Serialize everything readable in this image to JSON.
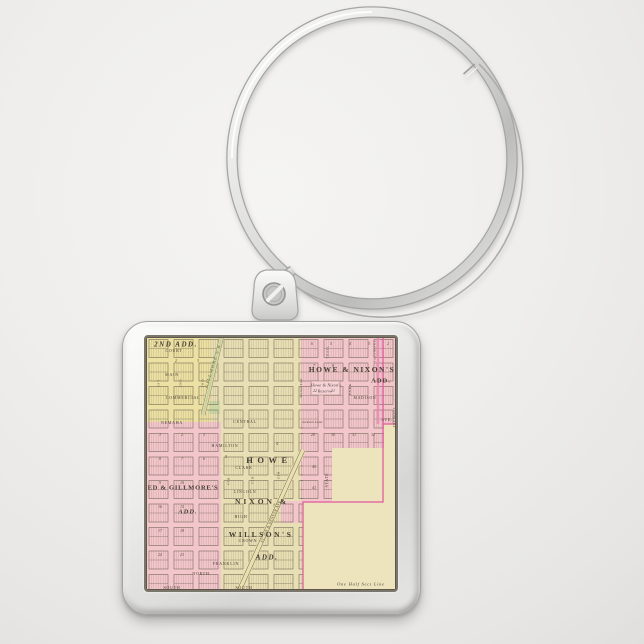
{
  "scene": {
    "background": "#efeeec",
    "metal_light": "#fbfbf9",
    "metal_mid": "#d8d8d6",
    "metal_dark": "#a8a8a6"
  },
  "map": {
    "colors": {
      "cream": "#e9dfb4",
      "cream_open": "#ede3bc",
      "yellow": "#ece0a2",
      "pink": "#f3c6cb",
      "pink_light": "#f6d2d6",
      "green": "#ccd7a5",
      "line": "#6a6150",
      "pink_line": "#e0589b",
      "rose_band": "#eb8ab4",
      "border": "#5f584a",
      "label": "#4b4338",
      "green_text": "#7c8d52"
    },
    "labels": [
      {
        "t": "2ND ADD.",
        "x": 60,
        "y": 16,
        "fs": 14,
        "ls": 3,
        "b": 1,
        "it": 1,
        "c": "#433d32"
      },
      {
        "t": "HOWE & NIXON'S",
        "x": 412,
        "y": 66,
        "fs": 15,
        "ls": 3,
        "b": 1,
        "c": "#433d32"
      },
      {
        "t": "ADD.",
        "x": 470,
        "y": 86,
        "fs": 13,
        "ls": 2,
        "b": 1,
        "c": "#433d32"
      },
      {
        "t": "Howe & Nixon's",
        "x": 360,
        "y": 96,
        "fs": 8.5,
        "it": 1,
        "ls": 0.3
      },
      {
        "t": "Reserve",
        "x": 358,
        "y": 108,
        "fs": 8.5,
        "it": 1,
        "ls": 0.3
      },
      {
        "t": "ED & GILLMORE'S",
        "x": 74,
        "y": 300,
        "fs": 13,
        "ls": 1.5,
        "b": 1,
        "c": "#433d32"
      },
      {
        "t": "ADD.",
        "x": 84,
        "y": 348,
        "fs": 13,
        "ls": 2,
        "b": 1,
        "it": 1,
        "c": "#433d32"
      },
      {
        "t": "HOWE",
        "x": 246,
        "y": 246,
        "fs": 17,
        "ls": 9,
        "b": 1,
        "c": "#433d32"
      },
      {
        "t": "NIXON &",
        "x": 232,
        "y": 330,
        "fs": 15,
        "ls": 6,
        "b": 1,
        "c": "#433d32"
      },
      {
        "t": "WILLSON'S",
        "x": 230,
        "y": 396,
        "fs": 15,
        "ls": 5,
        "b": 1,
        "c": "#433d32"
      },
      {
        "t": "ADD.",
        "x": 242,
        "y": 442,
        "fs": 14,
        "ls": 3,
        "b": 1,
        "it": 1,
        "c": "#433d32"
      },
      {
        "t": "One Half Sect Line",
        "x": 430,
        "y": 494,
        "fs": 9,
        "it": 1
      },
      {
        "t": "COURT",
        "x": 56,
        "y": 28,
        "fs": 8
      },
      {
        "t": "MAIN",
        "x": 52,
        "y": 76,
        "fs": 8
      },
      {
        "t": "COMMERCIAL",
        "x": 74,
        "y": 122,
        "fs": 8
      },
      {
        "t": "NEMAHA",
        "x": 52,
        "y": 172,
        "fs": 8
      },
      {
        "t": "CENTRAL",
        "x": 198,
        "y": 170,
        "fs": 8
      },
      {
        "t": "HAMILTON",
        "x": 158,
        "y": 218,
        "fs": 8
      },
      {
        "t": "CLARK",
        "x": 196,
        "y": 262,
        "fs": 8
      },
      {
        "t": "LINCOLN",
        "x": 198,
        "y": 310,
        "fs": 8
      },
      {
        "t": "HIGH",
        "x": 190,
        "y": 360,
        "fs": 8
      },
      {
        "t": "CROWN",
        "x": 204,
        "y": 408,
        "fs": 8
      },
      {
        "t": "FRANKLIN",
        "x": 160,
        "y": 454,
        "fs": 8
      },
      {
        "t": "NORTH",
        "x": 110,
        "y": 474,
        "fs": 8
      },
      {
        "t": "SOUTH",
        "x": 196,
        "y": 502,
        "fs": 8
      },
      {
        "t": "SOUTH",
        "x": 52,
        "y": 502,
        "fs": 8
      },
      {
        "t": "MADISON",
        "x": 438,
        "y": 122,
        "fs": 7.5
      },
      {
        "t": "AVE.",
        "x": 482,
        "y": 166,
        "fs": 7.5
      },
      {
        "t": "PARK",
        "x": 408,
        "y": 104,
        "fs": 7,
        "rot": -90
      },
      {
        "t": "STATE",
        "x": 362,
        "y": 286,
        "fs": 7.5,
        "rot": -90
      },
      {
        "t": "PASSMORE",
        "x": 458,
        "y": 28,
        "fs": 6.5,
        "rot": -90
      },
      {
        "t": "FREMONT",
        "x": 497,
        "y": 160,
        "fs": 6.5,
        "rot": -90
      },
      {
        "t": "TRAIL",
        "x": 364,
        "y": 30,
        "fs": 6.5,
        "rot": -90
      },
      {
        "t": "1ST",
        "x": 26,
        "y": 92,
        "fs": 6.5,
        "rot": -90
      },
      {
        "t": "2ND",
        "x": 70,
        "y": 92,
        "fs": 6.5,
        "rot": -90
      },
      {
        "t": "3RD",
        "x": 114,
        "y": 92,
        "fs": 6.5,
        "rot": -90
      },
      {
        "t": "4TH",
        "x": 166,
        "y": 288,
        "fs": 6.5,
        "rot": -90
      },
      {
        "t": "5TH",
        "x": 214,
        "y": 286,
        "fs": 6.5,
        "rot": -90
      },
      {
        "t": "6TH",
        "x": 266,
        "y": 276,
        "fs": 6.5,
        "rot": -90
      },
      {
        "t": "Jackson Lane",
        "x": 332,
        "y": 170,
        "fs": 7,
        "it": 1,
        "ls": 0.3
      },
      {
        "t": "Section Line",
        "x": 310,
        "y": 102,
        "fs": 7,
        "it": 1,
        "rot": -90,
        "ls": 0.3
      },
      {
        "t": "GILLMORE'S R",
        "x": 134,
        "y": 58,
        "fs": 9,
        "ls": 2,
        "b": 1,
        "rot": -73,
        "c": "#7c8d52"
      },
      {
        "t": "ST. JOE & DENVER AVE.",
        "x": 250,
        "y": 368,
        "fs": 7.5,
        "rot": -66,
        "ls": 0.5
      }
    ],
    "numbers": [
      {
        "t": "6",
        "x": 332,
        "y": 14
      },
      {
        "t": "5",
        "x": 370,
        "y": 14
      },
      {
        "t": "4",
        "x": 408,
        "y": 14
      },
      {
        "t": "3",
        "x": 446,
        "y": 14
      },
      {
        "t": "2",
        "x": 484,
        "y": 14
      },
      {
        "t": "7",
        "x": 336,
        "y": 58
      },
      {
        "t": "8",
        "x": 374,
        "y": 58
      },
      {
        "t": "22",
        "x": 338,
        "y": 108
      },
      {
        "t": "21",
        "x": 374,
        "y": 108
      },
      {
        "t": "29",
        "x": 334,
        "y": 196
      },
      {
        "t": "30",
        "x": 374,
        "y": 196
      },
      {
        "t": "31",
        "x": 416,
        "y": 196
      },
      {
        "t": "32",
        "x": 454,
        "y": 196
      },
      {
        "t": "1",
        "x": 28,
        "y": 196
      },
      {
        "t": "2",
        "x": 72,
        "y": 196
      },
      {
        "t": "3",
        "x": 116,
        "y": 196
      },
      {
        "t": "8",
        "x": 28,
        "y": 244
      },
      {
        "t": "7",
        "x": 72,
        "y": 244
      },
      {
        "t": "6",
        "x": 116,
        "y": 244
      },
      {
        "t": "9",
        "x": 28,
        "y": 292
      },
      {
        "t": "10",
        "x": 72,
        "y": 292
      },
      {
        "t": "16",
        "x": 28,
        "y": 340
      },
      {
        "t": "15",
        "x": 72,
        "y": 340
      },
      {
        "t": "17",
        "x": 28,
        "y": 388
      },
      {
        "t": "18",
        "x": 72,
        "y": 388
      },
      {
        "t": "24",
        "x": 28,
        "y": 436
      },
      {
        "t": "23",
        "x": 72,
        "y": 436
      },
      {
        "t": "5",
        "x": 160,
        "y": 240
      },
      {
        "t": "4",
        "x": 262,
        "y": 214
      },
      {
        "t": "40",
        "x": 336,
        "y": 260
      },
      {
        "t": "41",
        "x": 336,
        "y": 302
      },
      {
        "t": "2",
        "x": 60,
        "y": 48
      },
      {
        "t": "3",
        "x": 104,
        "y": 48
      }
    ]
  }
}
